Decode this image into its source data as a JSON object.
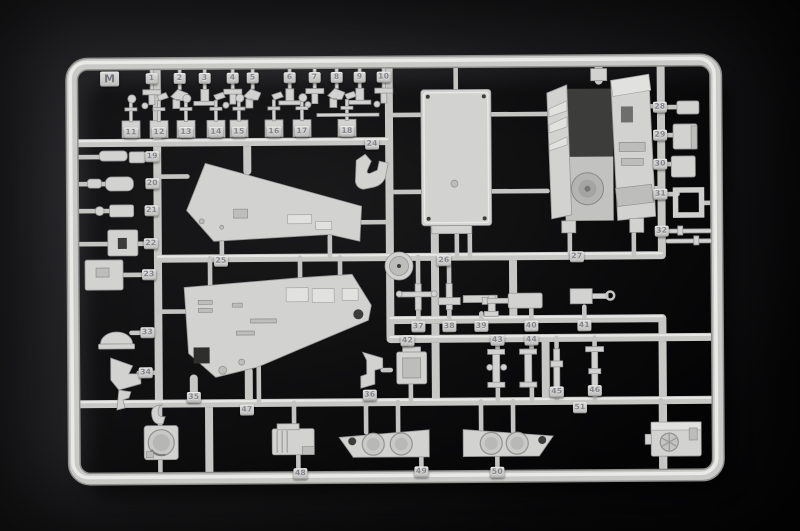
{
  "photo": {
    "subject": "Plastic model kit injection-molded parts sprue photographed on a dark surface",
    "sprue_letter": "M",
    "plastic_color": "#d2d2d0",
    "background_color": "#151517"
  },
  "letter_tag": {
    "label": "M",
    "x": 111,
    "y": 77
  },
  "part_tags": [
    {
      "label": "1",
      "x": 153,
      "y": 77
    },
    {
      "label": "2",
      "x": 181,
      "y": 77
    },
    {
      "label": "3",
      "x": 206,
      "y": 77
    },
    {
      "label": "4",
      "x": 234,
      "y": 77
    },
    {
      "label": "5",
      "x": 254,
      "y": 77
    },
    {
      "label": "6",
      "x": 291,
      "y": 77
    },
    {
      "label": "7",
      "x": 316,
      "y": 77
    },
    {
      "label": "8",
      "x": 338,
      "y": 77
    },
    {
      "label": "9",
      "x": 361,
      "y": 77
    },
    {
      "label": "10",
      "x": 385,
      "y": 77
    },
    {
      "label": "11",
      "x": 132,
      "y": 131
    },
    {
      "label": "12",
      "x": 160,
      "y": 131
    },
    {
      "label": "13",
      "x": 187,
      "y": 131
    },
    {
      "label": "14",
      "x": 217,
      "y": 131
    },
    {
      "label": "15",
      "x": 240,
      "y": 131
    },
    {
      "label": "16",
      "x": 275,
      "y": 131
    },
    {
      "label": "17",
      "x": 303,
      "y": 131
    },
    {
      "label": "18",
      "x": 348,
      "y": 131
    },
    {
      "label": "19",
      "x": 153,
      "y": 155
    },
    {
      "label": "20",
      "x": 153,
      "y": 182
    },
    {
      "label": "21",
      "x": 152,
      "y": 209
    },
    {
      "label": "22",
      "x": 151,
      "y": 242
    },
    {
      "label": "23",
      "x": 149,
      "y": 273
    },
    {
      "label": "24",
      "x": 373,
      "y": 144
    },
    {
      "label": "25",
      "x": 221,
      "y": 260
    },
    {
      "label": "26",
      "x": 444,
      "y": 261
    },
    {
      "label": "27",
      "x": 577,
      "y": 258
    },
    {
      "label": "28",
      "x": 661,
      "y": 109
    },
    {
      "label": "29",
      "x": 661,
      "y": 137
    },
    {
      "label": "30",
      "x": 661,
      "y": 166
    },
    {
      "label": "31",
      "x": 661,
      "y": 196
    },
    {
      "label": "32",
      "x": 662,
      "y": 233
    },
    {
      "label": "33",
      "x": 147,
      "y": 331
    },
    {
      "label": "34",
      "x": 145,
      "y": 371
    },
    {
      "label": "35",
      "x": 193,
      "y": 396
    },
    {
      "label": "36",
      "x": 369,
      "y": 395
    },
    {
      "label": "37",
      "x": 418,
      "y": 327
    },
    {
      "label": "38",
      "x": 449,
      "y": 327
    },
    {
      "label": "39",
      "x": 481,
      "y": 327
    },
    {
      "label": "40",
      "x": 531,
      "y": 327
    },
    {
      "label": "41",
      "x": 584,
      "y": 327
    },
    {
      "label": "42",
      "x": 407,
      "y": 341
    },
    {
      "label": "43",
      "x": 497,
      "y": 341
    },
    {
      "label": "44",
      "x": 531,
      "y": 341
    },
    {
      "label": "45",
      "x": 556,
      "y": 393
    },
    {
      "label": "46",
      "x": 594,
      "y": 392
    },
    {
      "label": "47",
      "x": 246,
      "y": 409
    },
    {
      "label": "48",
      "x": 299,
      "y": 473
    },
    {
      "label": "49",
      "x": 420,
      "y": 472
    },
    {
      "label": "50",
      "x": 496,
      "y": 473
    },
    {
      "label": "51",
      "x": 579,
      "y": 409
    }
  ]
}
